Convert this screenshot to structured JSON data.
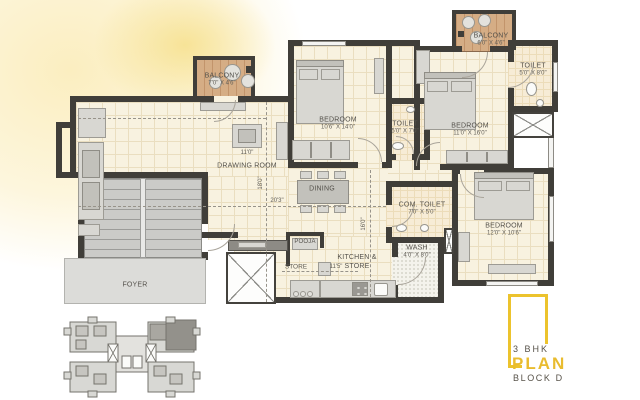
{
  "page": {
    "title": "3 BHK Plan Block D"
  },
  "colors": {
    "accent_gold": "#E9BC2F",
    "wall": "#403E39",
    "floor_cream": "#F8F2E0",
    "balcony_wood": "#D5AD85",
    "keyplan_highlight": "#93918B"
  },
  "rooms": {
    "balcony_left": {
      "name": "BALCONY",
      "dim": "7'0\" X 4'6\""
    },
    "drawing_room": {
      "name": "DRAWING ROOM"
    },
    "bedroom1": {
      "name": "BEDROOM",
      "dim": "10'6\" X 14'0\""
    },
    "balcony_top": {
      "name": "BALCONY",
      "dim": "6'0\" X 4'6\""
    },
    "toilet_top": {
      "name": "TOILET",
      "dim": "5'0\" X 8'0\""
    },
    "bedroom2": {
      "name": "BEDROOM",
      "dim": "11'0\" X 16'0\""
    },
    "toilet_mid": {
      "name": "TOILET",
      "dim": "5'0\" X 7'0\""
    },
    "dining": {
      "name": "DINING"
    },
    "com_toilet": {
      "name": "COM. TOILET",
      "dim": "7'0\" X 5'0\""
    },
    "bedroom3": {
      "name": "BEDROOM",
      "dim": "12'0\" X 10'6\""
    },
    "wash": {
      "name": "WASH",
      "dim": "4'0\" X 8'0\""
    },
    "pooja": {
      "name": "POOJA"
    },
    "store": {
      "name": "STORE"
    },
    "kitchen_store": {
      "line1": "KITCHEN &",
      "line2": "STORE"
    },
    "foyer": {
      "name": "FOYER"
    }
  },
  "dimensions": {
    "drawing_width": "11'0\"",
    "drawing_length": "18'0\"",
    "hall_width": "20'3\"",
    "kitchen_length": "16'0\"",
    "store_width": "11'5\""
  },
  "logo": {
    "line1": "3 BHK",
    "line2": "PLAN",
    "line3": "BLOCK D"
  }
}
